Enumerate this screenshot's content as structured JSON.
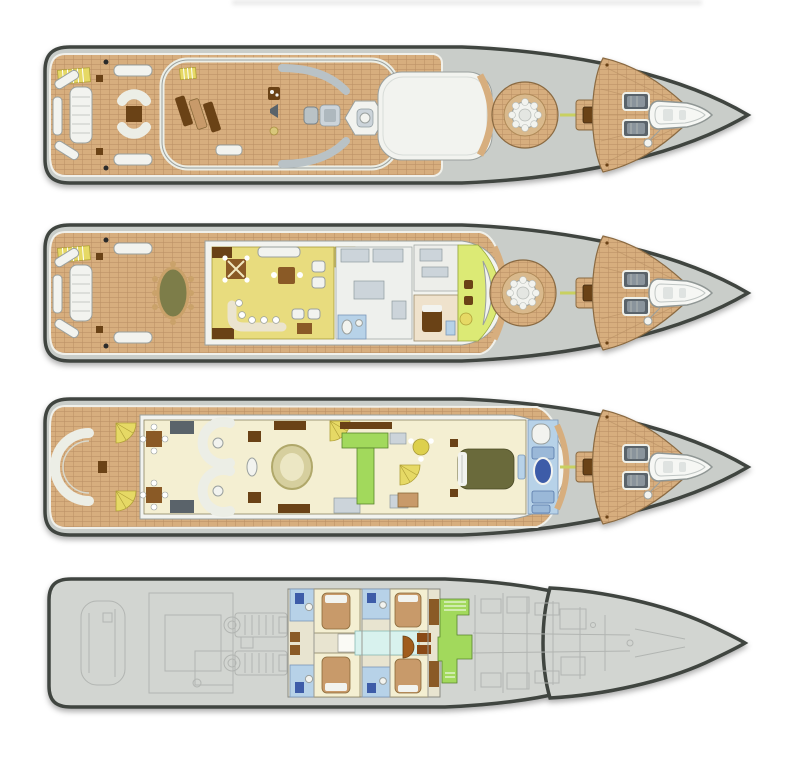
{
  "figure": {
    "title": "Yacht deck plans (general arrangement), four decks, bow facing right",
    "type": "yacht-deck-plan-diagram",
    "orientation": "bow-right",
    "deck_count": 4,
    "cropped_text_fragment_visible": true
  },
  "decks": [
    {
      "id": "sun-deck",
      "name": "Sun Deck",
      "zones": [
        "stern-lounge",
        "stair-hatch",
        "sun-lounger-platform",
        "wet-bar-icons",
        "helm-pod",
        "hexagonal-spa",
        "hardtop-roof",
        "crows-nest-platform",
        "bow-connector",
        "foredeck-seating",
        "tender",
        "anchor-winch"
      ]
    },
    {
      "id": "bridge-deck",
      "name": "Bridge Deck",
      "zones": [
        "stern-lounge",
        "al-fresco-dining-table",
        "skylounge",
        "game-table",
        "bar",
        "pantry",
        "day-head",
        "captain-cabin",
        "wheelhouse",
        "crows-nest-platform",
        "bow-connector",
        "foredeck-seating",
        "tender",
        "anchor-winch"
      ]
    },
    {
      "id": "main-deck",
      "name": "Main Deck",
      "zones": [
        "aft-deck-sofa",
        "stair-fans",
        "aft-dining-tables",
        "main-salon-curved-sofas",
        "formal-dining-oval-table",
        "lobby-stairs",
        "galley",
        "study",
        "master-bedroom",
        "master-bathroom",
        "bow-connector",
        "foredeck-seating",
        "tender",
        "anchor-winch"
      ]
    },
    {
      "id": "lower-deck",
      "name": "Lower Deck",
      "zones": [
        "lazarette-garage",
        "engine-room",
        "guest-cabins",
        "guest-bathrooms",
        "corridor",
        "stair-laundry",
        "crew-quarters",
        "forepeak"
      ]
    }
  ],
  "shared_components": [
    "crows-nest-platform",
    "bow-connector-box",
    "foredeck-seat-boxes",
    "bow-tender",
    "anchor-winch"
  ],
  "palette": {
    "background": "#ffffff",
    "hull_outline": "#3f4540",
    "hull_fill": "#c9cdc9",
    "hull_fill_light": "#d2d5d1",
    "caprail": "#f0f0ea",
    "teak": "#d7ae7e",
    "teak_dark_line": "#b98f62",
    "white_structure": "#f2f3ef",
    "structure_stroke": "#9aa09e",
    "interior_cream": "#f4efd2",
    "interior_yellow": "#e8dc7e",
    "wheelhouse_green": "#dcea75",
    "galley_green": "#a2d95c",
    "stairs_yellow": "#e6d965",
    "bath_blue": "#b7d2e8",
    "fixture_blue": "#3c5ca8",
    "corridor_cyan": "#d8f2ee",
    "wood_brown": "#8a5a28",
    "dark_brown": "#6b4318",
    "bed_tan": "#c89a6a",
    "bed_olive": "#6b6b3a",
    "slate_gray": "#5a646a",
    "furniture_gray": "#b9c2c6",
    "ghost_line": "#b2b5b2"
  }
}
